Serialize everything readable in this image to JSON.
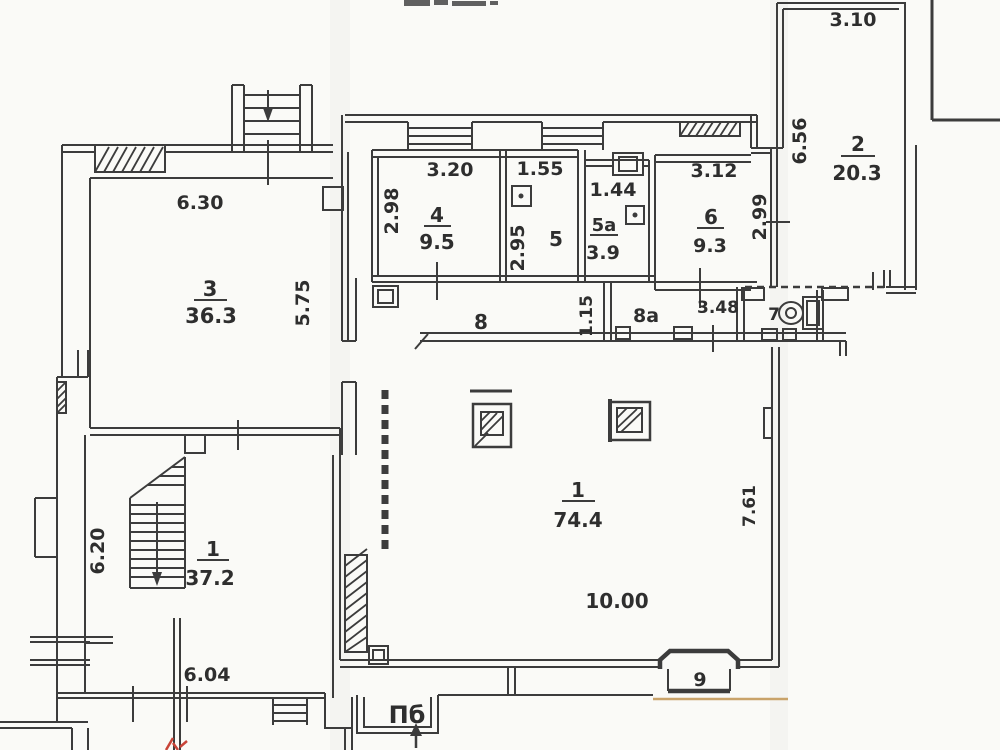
{
  "plan": {
    "rooms": {
      "r3": {
        "num": "3",
        "area": "36.3"
      },
      "r4": {
        "num": "4",
        "area": "9.5"
      },
      "r5": {
        "num": "5"
      },
      "r5a": {
        "num": "5a",
        "area": "3.9"
      },
      "r6": {
        "num": "6",
        "area": "9.3"
      },
      "r2": {
        "num": "2",
        "area": "20.3"
      },
      "r8": {
        "num": "8"
      },
      "r8a": {
        "num": "8a"
      },
      "r7": {
        "num": "7"
      },
      "r9": {
        "num": "9"
      },
      "r1_hall": {
        "num": "1",
        "area": "74.4"
      },
      "r1_stair": {
        "num": "1",
        "area": "37.2"
      }
    },
    "dims": {
      "w_room3": "6.30",
      "h_room3": "5.75",
      "w_room4": "3.20",
      "h_room4": "2.98",
      "w_room5": "1.55",
      "h_room5": "2.95",
      "w_room5a": "1.44",
      "w_room6": "3.12",
      "h_room6": "2.99",
      "w_room2": "3.10",
      "h_room2": "6.56",
      "w_corr8": "1.15",
      "w_corr8a": "3.48",
      "h_room1_stair": "6.20",
      "w_room1_stair": "6.04",
      "w_room1_hall": "10.00",
      "h_room1_hall": "7.61"
    },
    "marks": {
      "entrance": "Пб"
    },
    "colors": {
      "ink": "#3c3c3c",
      "red": "#c84438",
      "tan": "#c9a36a",
      "paper": "#fafaf7"
    }
  }
}
